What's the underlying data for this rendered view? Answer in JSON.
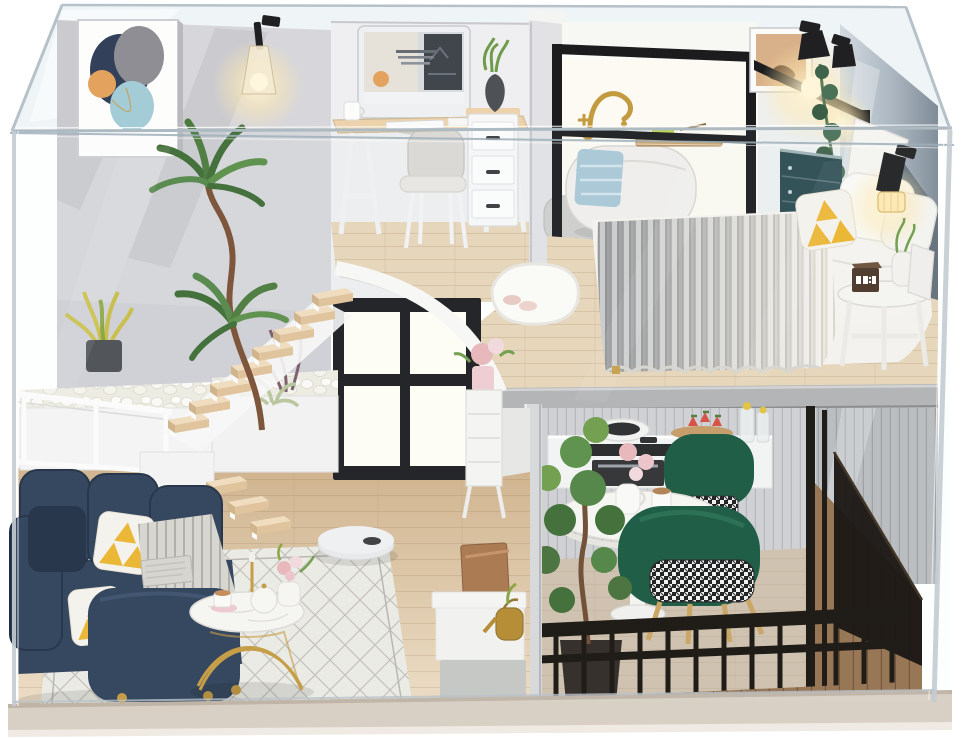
{
  "alt": "Product photo of a DIY miniature dollhouse kit: a modern two-story loft apartment with bedroom, bathroom and office upstairs, living room, dining area and kitchen downstairs, displayed inside a clear acrylic dust-proof case",
  "visible_text": [],
  "scene": {
    "objects": [
      "clear acrylic display case",
      "abstract wall art",
      "glass wall sconce",
      "desktop computer workstation",
      "white desk chair",
      "drawer cabinet",
      "freestanding bathtub",
      "gold gooseneck faucet",
      "blue towel",
      "bath caddy tray",
      "framed cat artwork",
      "black reading lamps",
      "double bed with chunky knit blanket",
      "yellow triangle pillow",
      "teal dresser",
      "bedside stool with alarm clock",
      "white fluffy rug",
      "floating wood staircase",
      "white pebble planters",
      "dracaena plant",
      "black four-pane window",
      "navy boucle sofa",
      "striped throw blanket",
      "marble coffee table with gold legs",
      "robot vacuum",
      "diamond lattice rug",
      "round pedestal dining table",
      "green velvet chairs",
      "houndstooth cushions",
      "kitchen counter with cooktop and pan",
      "strawberry dessert board",
      "potted ficus tree",
      "black balcony railing",
      "wooden deck",
      "gold watering can",
      "parcel box"
    ]
  },
  "colors": {
    "bg": "#ffffff",
    "acrylic_edge": "#b6c1c9",
    "acrylic_tint": "#e9f0f4",
    "wall_left": "#d6d6db",
    "wall_office": "#efeff1",
    "wall_bath": "#fbfbf8",
    "headboard_wall": "#5d6873",
    "frame_black": "#1c1c1f",
    "gold": "#c49a3f",
    "wood_step": "#ecd3ac",
    "wood_floor": "#d8bc9a",
    "mezz_wood": "#e7d5b9",
    "mezz_fascia": "#b2b3b5",
    "deck_wood": "#95714e",
    "dining_floor": "#cfc0ad",
    "sofa": "#2e4059",
    "sofa_dark": "#202e44",
    "pillow_yellow": "#edb52e",
    "throw_grey": "#d8d5cf",
    "rug": "#edebe6",
    "rug_line": "#b8b5ad",
    "table_white": "#f7f6f3",
    "chair_green": "#17573f",
    "chair_green_light": "#27male",
    "railing": "#17120d",
    "pebble": "#f3f0e8",
    "plant_dark": "#3e6b33",
    "plant_light": "#6f9c4a",
    "plant_yellow": "#c9bd45",
    "blanket_grey": "#9fa1a3",
    "blanket_cream": "#f0ece4",
    "bed_white": "#f5f3ef",
    "towel_blue": "#a9c8d6",
    "tub_white": "#f1efec",
    "dresser_teal": "#2c4b52",
    "lamp_black": "#202022",
    "art_navy": "#32405a",
    "art_grey": "#8e8e94",
    "art_orange": "#e3a35f",
    "art_teal": "#a3ccd6",
    "curtain": "#cfd0d3",
    "counter": "#f4f4f4",
    "stove": "#232426",
    "vacuum": "#e9e9eb",
    "base": "#d9d0c5",
    "base_edge": "#bfb4a6",
    "box_brown": "#a9754c",
    "rose_pink": "#e8b7bb",
    "clock_body": "#4a3526",
    "divider": "#d8d8da",
    "cabinet_grey": "#c6c7c5"
  }
}
